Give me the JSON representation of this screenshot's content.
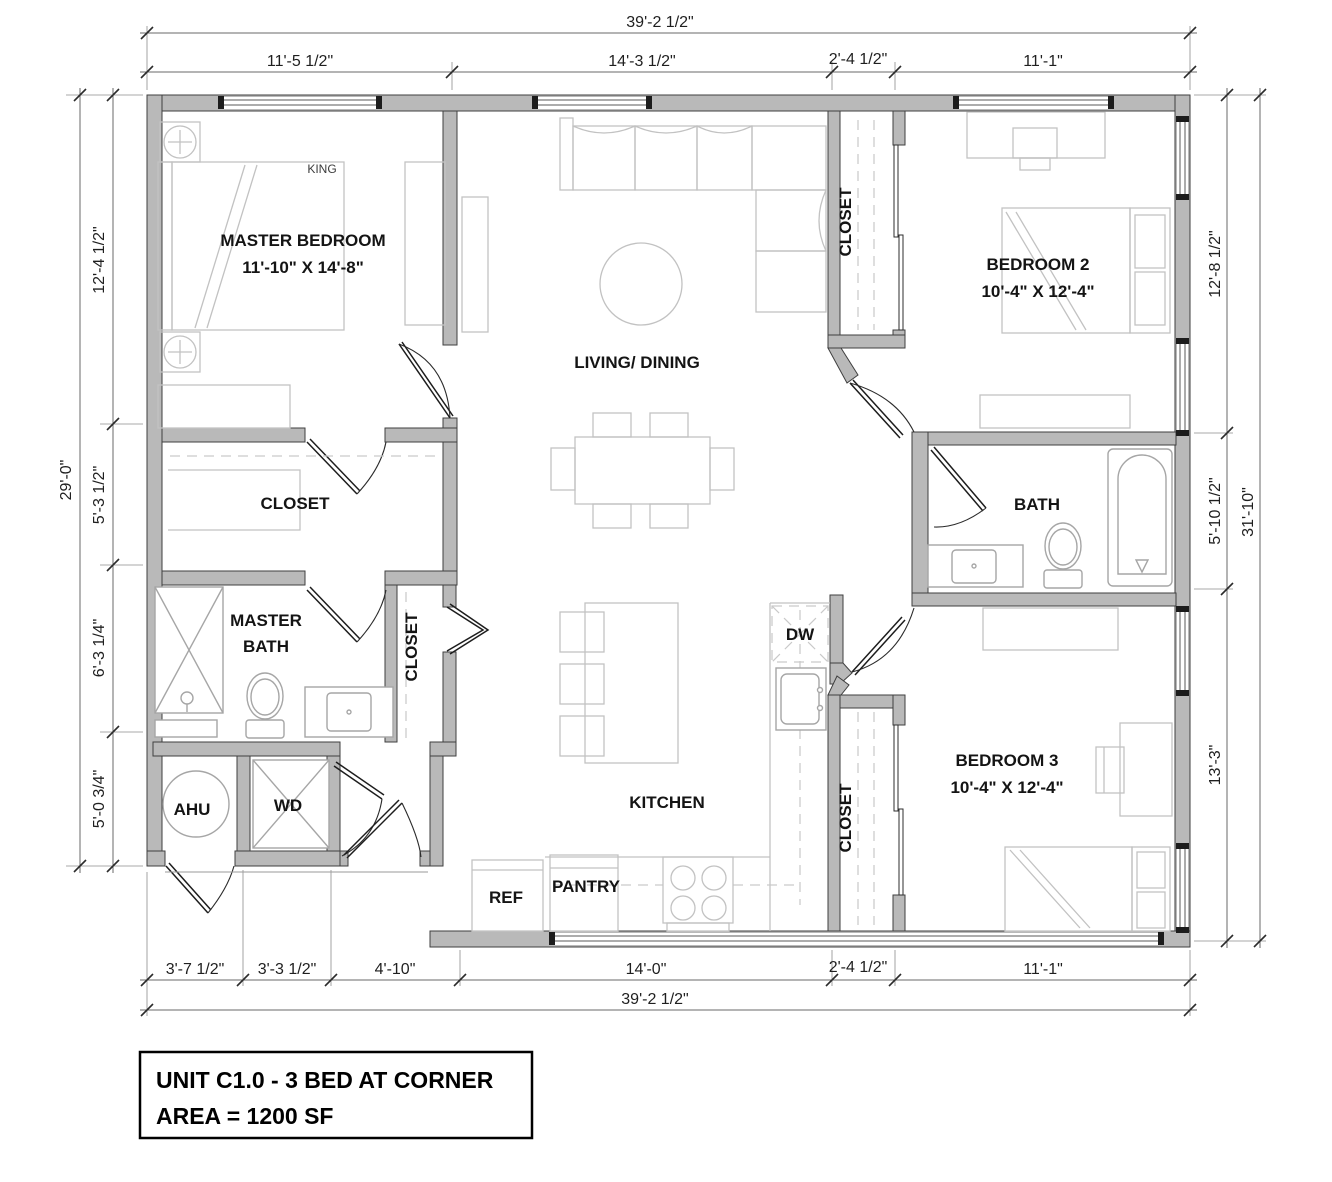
{
  "title": {
    "line1": "UNIT C1.0 - 3 BED AT CORNER",
    "line2": "AREA = 1200 SF"
  },
  "rooms": {
    "master_bedroom": {
      "name": "MASTER BEDROOM",
      "size": "11'-10\" X 14'-8\"",
      "bed": "KING"
    },
    "living_dining": {
      "name": "LIVING/ DINING"
    },
    "bedroom2": {
      "name": "BEDROOM 2",
      "size": "10'-4\" X 12'-4\""
    },
    "bedroom3": {
      "name": "BEDROOM 3",
      "size": "10'-4\" X 12'-4\""
    },
    "bath": {
      "name": "BATH"
    },
    "master_bath": {
      "line1": "MASTER",
      "line2": "BATH"
    },
    "closet": {
      "name": "CLOSET"
    },
    "kitchen": {
      "name": "KITCHEN"
    },
    "ahu": {
      "name": "AHU"
    },
    "wd": {
      "name": "WD"
    },
    "ref": {
      "name": "REF"
    },
    "pantry": {
      "name": "PANTRY"
    },
    "dw": {
      "name": "DW"
    }
  },
  "dimensions": {
    "top_overall": "39'-2 1/2\"",
    "top": [
      "11'-5 1/2\"",
      "14'-3 1/2\"",
      "2'-4 1/2\"",
      "11'-1\""
    ],
    "bottom": [
      "3'-7 1/2\"",
      "3'-3 1/2\"",
      "4'-10\"",
      "14'-0\"",
      "2'-4 1/2\"",
      "11'-1\""
    ],
    "bottom_overall": "39'-2 1/2\"",
    "left": [
      "12'-4 1/2\"",
      "5'-3 1/2\"",
      "6'-3 1/4\"",
      "5'-0 3/4\""
    ],
    "left_overall": "29'-0\"",
    "right": [
      "12'-8 1/2\"",
      "5'-10 1/2\"",
      "13'-3\""
    ],
    "right_overall": "31'-10\""
  },
  "colors": {
    "wall_fill": "#b9b9b9",
    "wall_stroke": "#3f3f3f",
    "furniture": "#c2c2c2",
    "dimension_line": "#6a6a6a",
    "text": "#141414"
  }
}
